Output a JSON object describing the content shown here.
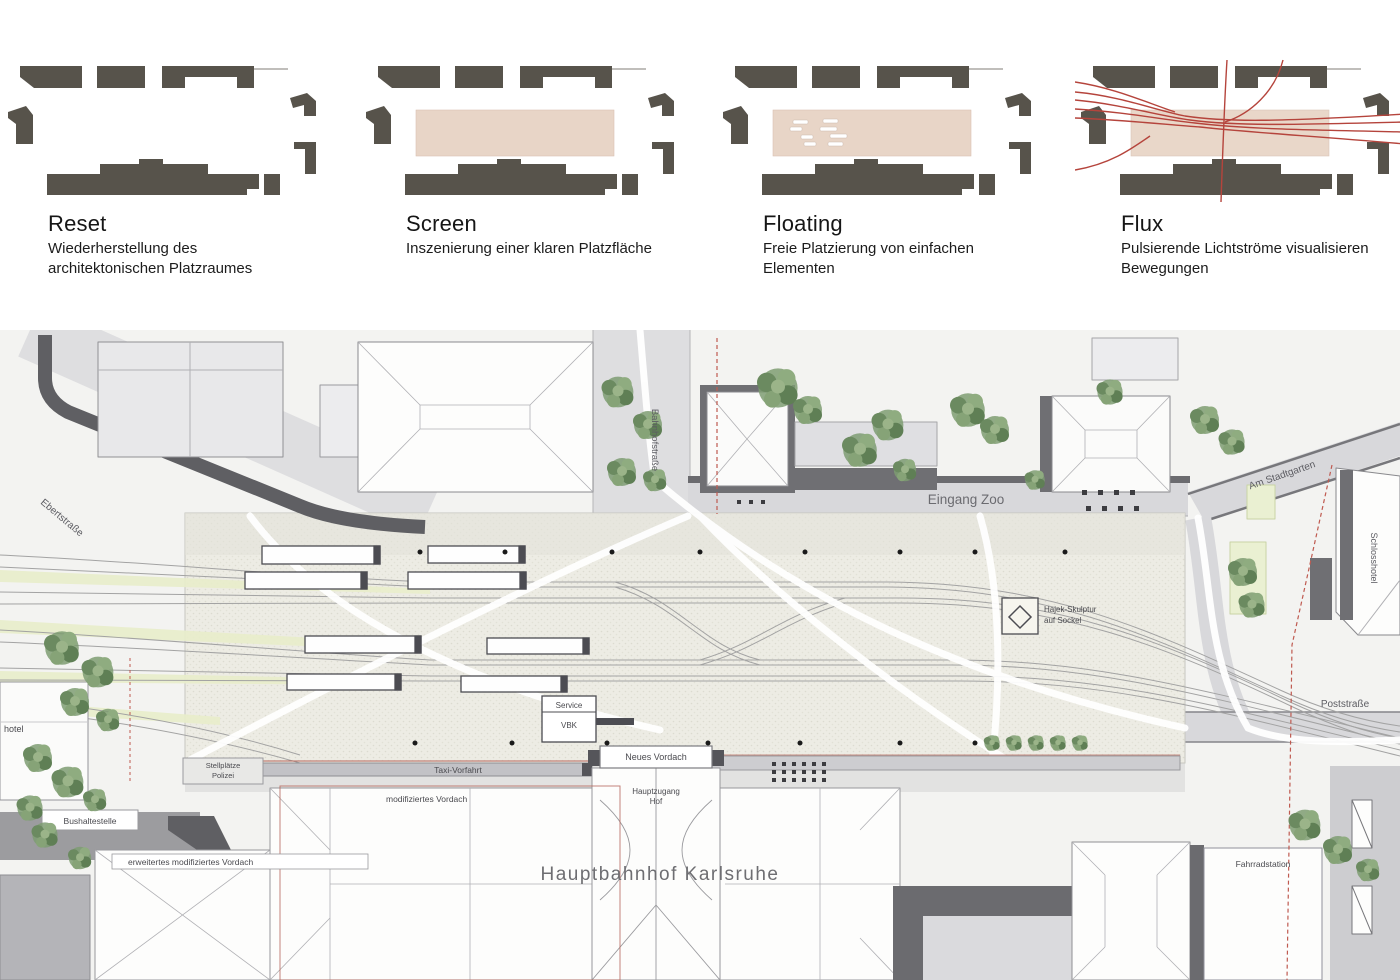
{
  "concepts": [
    {
      "title": "Reset",
      "subtitle": "Wiederherstellung des architektonischen Platzraumes"
    },
    {
      "title": "Screen",
      "subtitle": "Inszenierung einer klaren Platzfläche"
    },
    {
      "title": "Floating",
      "subtitle": "Freie Platzierung von einfachen Elementen"
    },
    {
      "title": "Flux",
      "subtitle": "Pulsierende Lichtströme visualisieren Bewegungen"
    }
  ],
  "plan": {
    "title": "Hauptbahnhof Karlsruhe",
    "streets": {
      "ebertstrasse": "Ebertstraße",
      "bahnhofstrasse": "Bahnhofstraße",
      "am_stadtgarten": "Am Stadtgarten",
      "poststrasse": "Poststraße"
    },
    "labels": {
      "eingang_zoo": "Eingang Zoo",
      "schlosshotel": "Schlosshotel",
      "hotel_west": "hotel",
      "stellplaetze_1": "Stellplätze",
      "stellplaetze_2": "Polizei",
      "bushaltestelle": "Bushaltestelle",
      "taxi_vorfahrt": "Taxi-Vorfahrt",
      "modifiziertes_vordach": "modifiziertes Vordach",
      "erweitertes_vordach": "erweitertes modifiziertes Vordach",
      "neues_vordach": "Neues Vordach",
      "hauptzugang_1": "Hauptzugang",
      "hauptzugang_2": "Hof",
      "service_1": "Service",
      "service_2": "VBK",
      "hajek_1": "Hajek-Skulptur",
      "hajek_2": "auf Sockel",
      "fahrradstation": "Fahrradstation"
    },
    "colors": {
      "footprint": "#57534b",
      "screen_fill": "#e8d5c7",
      "flux_line": "#b5443c",
      "tree_green": "#74936a",
      "boundary_red": "#bf5a50"
    }
  }
}
